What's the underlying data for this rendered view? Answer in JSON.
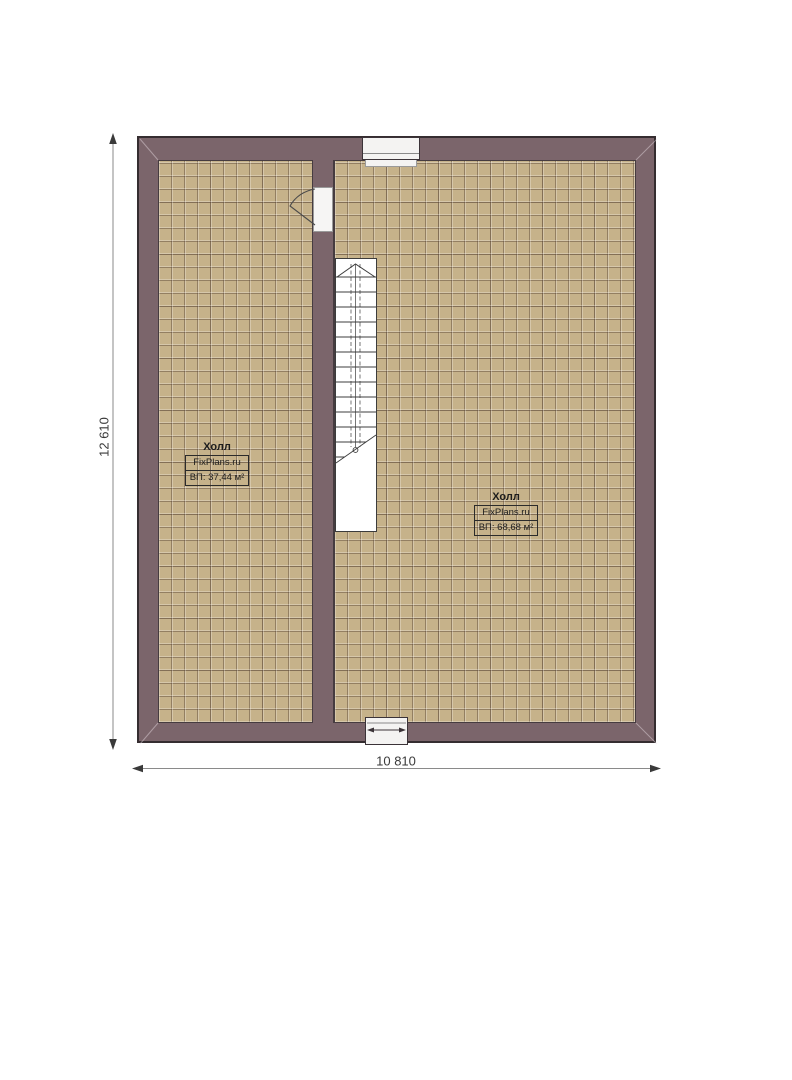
{
  "plan": {
    "dimension_vertical": "12 610",
    "dimension_horizontal": "10 810",
    "rooms": [
      {
        "name": "Холл",
        "watermark": "FixPlans.ru",
        "area_label": "ВП: 37,44 м²"
      },
      {
        "name": "Холл",
        "watermark": "FixPlans.ru",
        "area_label": "ВП: 68,68 м²"
      }
    ],
    "colors": {
      "wall_fill": "#7b656b",
      "wall_outline": "#352d30",
      "floor_fill": "#c6b28a",
      "floor_grid_line": "#60604c3a",
      "stair_line": "#3c3c3c",
      "dimension_line": "#808080",
      "dimension_text": "#3a3a3a",
      "label_text": "#1d1d1d"
    }
  }
}
